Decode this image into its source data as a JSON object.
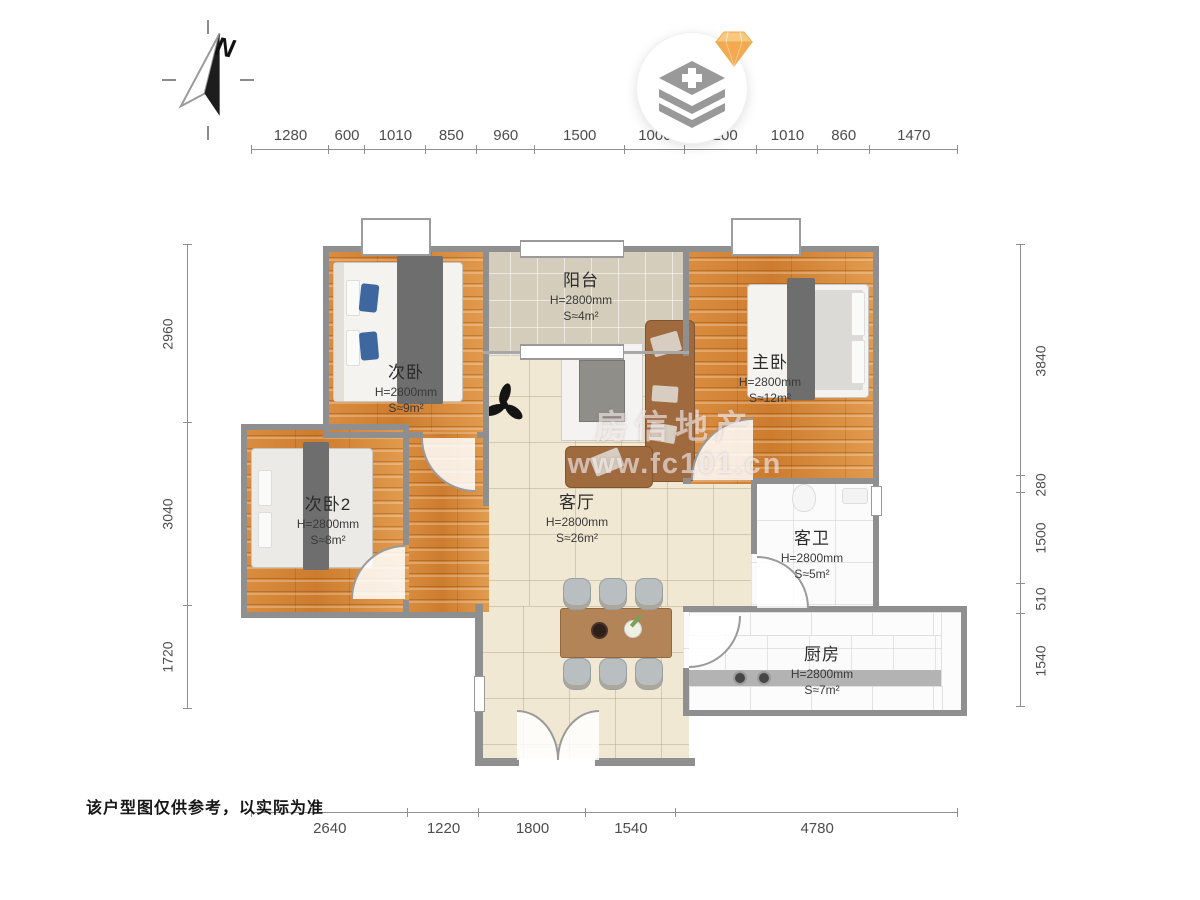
{
  "compass": {
    "label": "N"
  },
  "rooms": [
    {
      "name": "次卧",
      "height": "H=2800mm",
      "area": "S≈9m²"
    },
    {
      "name": "阳台",
      "height": "H=2800mm",
      "area": "S≈4m²"
    },
    {
      "name": "主卧",
      "height": "H=2800mm",
      "area": "S≈12m²"
    },
    {
      "name": "次卧2",
      "height": "H=2800mm",
      "area": "S≈8m²"
    },
    {
      "name": "客厅",
      "height": "H=2800mm",
      "area": "S≈26m²"
    },
    {
      "name": "客卫",
      "height": "H=2800mm",
      "area": "S≈5m²"
    },
    {
      "name": "厨房",
      "height": "H=2800mm",
      "area": "S≈7m²"
    }
  ],
  "dimensions": {
    "top": [
      1280,
      600,
      1010,
      850,
      960,
      1500,
      1000,
      1200,
      1010,
      860,
      1470
    ],
    "bottom": [
      2640,
      1220,
      1800,
      1540,
      4780
    ],
    "left": [
      2960,
      3040,
      1720
    ],
    "right": [
      3840,
      280,
      1500,
      510,
      1540
    ]
  },
  "watermark": {
    "line1": "房信地产",
    "line2": "www.fc101.cn"
  },
  "footer": {
    "disclaimer": "该户型图仅供参考，以实际为准"
  },
  "colors": {
    "wall": "#8f8f8f",
    "wood": "#d8893c",
    "living_tile": "#f1e8d3",
    "balcony_tile": "#d4cdbb",
    "white_tile": "#fbfbfb",
    "diamond_accent": "#f3a94f"
  }
}
